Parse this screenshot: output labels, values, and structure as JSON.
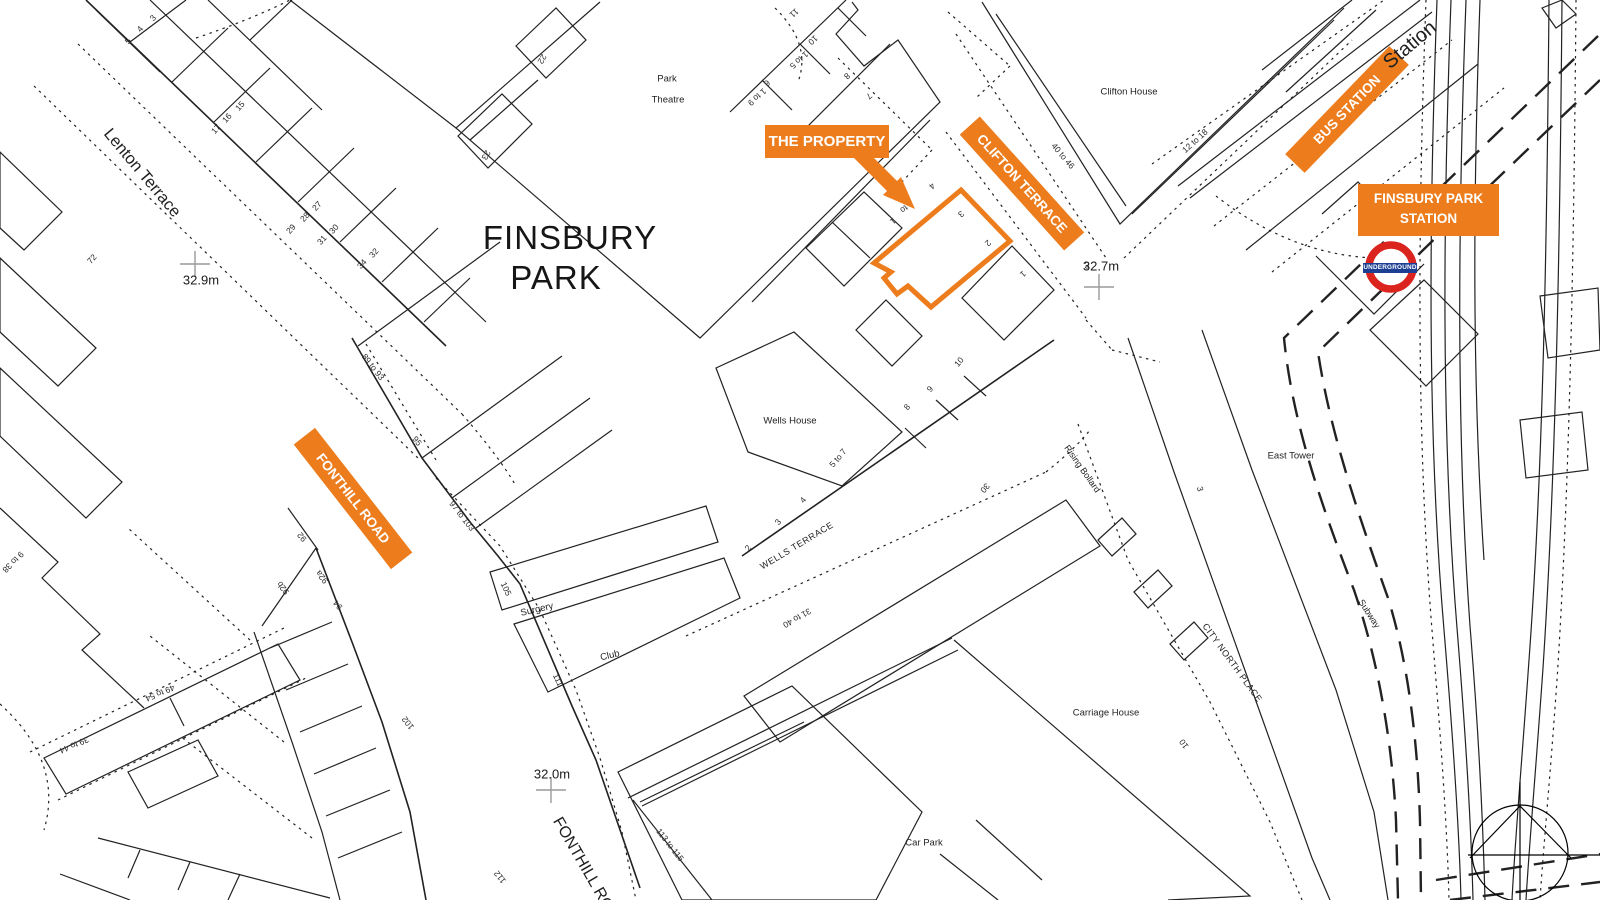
{
  "title": {
    "line1": "FINSBURY",
    "line2": "PARK"
  },
  "orange": {
    "accent": "#EC7C1C",
    "the_property": "THE PROPERTY",
    "clifton_terrace": "CLIFTON TERRACE",
    "bus_station": "BUS STATION",
    "station_line1": "FINSBURY PARK",
    "station_line2": "STATION",
    "fonthill_road": "FONTHILL ROAD"
  },
  "roundel": {
    "text": "UNDERGROUND",
    "red": "#DC241F",
    "blue": "#1C3F94"
  },
  "labels": [
    {
      "t": "Lenton Terrace",
      "x": 142,
      "y": 173,
      "r": 50,
      "s": 16.5,
      "c": "#1f1f1f",
      "n": "street-label-lenton-terrace"
    },
    {
      "t": "Station",
      "x": 1410,
      "y": 45,
      "r": -40,
      "s": 20,
      "c": "#1f1f1f",
      "n": "street-label-station"
    },
    {
      "t": "WELLS TERRACE",
      "x": 797,
      "y": 546,
      "r": -31,
      "s": 9,
      "ls": 0.6,
      "c": "#1f1f1f",
      "n": "street-label-wells-terrace"
    },
    {
      "t": "FONTHILL ROAD",
      "x": 588,
      "y": 874,
      "r": 60,
      "s": 16,
      "c": "#1f1f1f",
      "n": "street-label-fonthill-road-bottom"
    },
    {
      "t": "CITY NORTH PLACE",
      "x": 1232,
      "y": 663,
      "r": 54,
      "s": 9,
      "ls": 0.5,
      "c": "#1f1f1f",
      "n": "street-label-city-north-place"
    },
    {
      "t": "Subway",
      "x": 1369,
      "y": 614,
      "r": 57,
      "s": 9,
      "c": "#1f1f1f",
      "n": "street-label-subway"
    },
    {
      "t": "Rising Bollard",
      "x": 1082,
      "y": 469,
      "r": 55,
      "s": 9,
      "c": "#1f1f1f",
      "n": "annotation-rising-bollard"
    },
    {
      "t": "Park",
      "x": 667,
      "y": 79,
      "r": 0,
      "s": 9.5,
      "c": "#1f1f1f",
      "n": "building-label-park-theatre-1"
    },
    {
      "t": "Theatre",
      "x": 668,
      "y": 100,
      "r": 0,
      "s": 9.5,
      "c": "#1f1f1f",
      "n": "building-label-park-theatre-2"
    },
    {
      "t": "Clifton House",
      "x": 1129,
      "y": 92,
      "r": 0,
      "s": 9.5,
      "c": "#1f1f1f",
      "n": "building-label-clifton-house"
    },
    {
      "t": "Wells House",
      "x": 790,
      "y": 421,
      "r": 0,
      "s": 9.5,
      "c": "#1f1f1f",
      "n": "building-label-wells-house"
    },
    {
      "t": "Surgery",
      "x": 537,
      "y": 610,
      "r": -13,
      "s": 9.5,
      "c": "#1f1f1f",
      "n": "building-label-surgery"
    },
    {
      "t": "Club",
      "x": 610,
      "y": 656,
      "r": -13,
      "s": 9.5,
      "c": "#1f1f1f",
      "n": "building-label-club"
    },
    {
      "t": "East Tower",
      "x": 1291,
      "y": 456,
      "r": 0,
      "s": 9.5,
      "c": "#1f1f1f",
      "n": "building-label-east-tower"
    },
    {
      "t": "Carriage House",
      "x": 1106,
      "y": 713,
      "r": 0,
      "s": 9.5,
      "c": "#1f1f1f",
      "n": "building-label-carriage-house"
    },
    {
      "t": "Car Park",
      "x": 924,
      "y": 843,
      "r": 0,
      "s": 9.5,
      "c": "#1f1f1f",
      "n": "area-label-car-park"
    },
    {
      "t": "32.9m",
      "x": 201,
      "y": 280,
      "r": 0,
      "s": 13,
      "c": "#1a1a1a",
      "n": "spot-height-32-9m"
    },
    {
      "t": "32.7m",
      "x": 1101,
      "y": 266,
      "r": 0,
      "s": 13,
      "c": "#1a1a1a",
      "n": "spot-height-32-7m"
    },
    {
      "t": "32.0m",
      "x": 552,
      "y": 774,
      "r": 0,
      "s": 13,
      "c": "#1a1a1a",
      "n": "spot-height-32-0m"
    },
    {
      "t": "3",
      "x": 153,
      "y": 18,
      "r": -48,
      "n": "house-number"
    },
    {
      "t": "4",
      "x": 140,
      "y": 29,
      "r": -48,
      "n": "house-number"
    },
    {
      "t": "5",
      "x": 128,
      "y": 41,
      "r": -48,
      "n": "house-number"
    },
    {
      "t": "15",
      "x": 240,
      "y": 106,
      "r": -48,
      "n": "house-number"
    },
    {
      "t": "16",
      "x": 227,
      "y": 118,
      "r": -48,
      "n": "house-number"
    },
    {
      "t": "17",
      "x": 216,
      "y": 129,
      "r": -48,
      "n": "house-number"
    },
    {
      "t": "27",
      "x": 317,
      "y": 206,
      "r": -48,
      "n": "house-number"
    },
    {
      "t": "28",
      "x": 305,
      "y": 217,
      "r": -48,
      "n": "house-number"
    },
    {
      "t": "29",
      "x": 291,
      "y": 229,
      "r": -48,
      "n": "house-number"
    },
    {
      "t": "30",
      "x": 334,
      "y": 229,
      "r": -48,
      "n": "house-number"
    },
    {
      "t": "31",
      "x": 322,
      "y": 240,
      "r": -48,
      "n": "house-number"
    },
    {
      "t": "32",
      "x": 374,
      "y": 253,
      "r": -48,
      "n": "house-number"
    },
    {
      "t": "34",
      "x": 362,
      "y": 264,
      "r": -48,
      "n": "house-number"
    },
    {
      "t": "72",
      "x": 92,
      "y": 259,
      "r": -48,
      "n": "house-number"
    },
    {
      "t": "22",
      "x": 542,
      "y": 59,
      "r": 120,
      "n": "house-number"
    },
    {
      "t": "23",
      "x": 486,
      "y": 155,
      "r": 120,
      "n": "house-number"
    },
    {
      "t": "11",
      "x": 794,
      "y": 13,
      "r": 138,
      "n": "house-number"
    },
    {
      "t": "10",
      "x": 813,
      "y": 40,
      "r": 138,
      "n": "house-number"
    },
    {
      "t": "1 to 5",
      "x": 799,
      "y": 60,
      "r": 138,
      "n": "house-number"
    },
    {
      "t": "6",
      "x": 767,
      "y": 83,
      "r": 138,
      "n": "house-number"
    },
    {
      "t": "1 to 9",
      "x": 757,
      "y": 97,
      "r": 138,
      "n": "house-number"
    },
    {
      "t": "8",
      "x": 847,
      "y": 76,
      "r": 138,
      "n": "house-number"
    },
    {
      "t": "7",
      "x": 869,
      "y": 96,
      "r": 138,
      "n": "house-number"
    },
    {
      "t": "4",
      "x": 932,
      "y": 186,
      "r": 138,
      "n": "house-number"
    },
    {
      "t": "to",
      "x": 904,
      "y": 209,
      "r": 138,
      "n": "house-number"
    },
    {
      "t": "1",
      "x": 893,
      "y": 221,
      "r": 138,
      "n": "house-number"
    },
    {
      "t": "3",
      "x": 961,
      "y": 214,
      "r": 138,
      "n": "house-number"
    },
    {
      "t": "2",
      "x": 988,
      "y": 243,
      "r": 138,
      "n": "house-number"
    },
    {
      "t": "1",
      "x": 1023,
      "y": 274,
      "r": 138,
      "n": "house-number"
    },
    {
      "t": "40 to 46",
      "x": 1063,
      "y": 156,
      "r": 50,
      "n": "house-number"
    },
    {
      "t": "12 to 18",
      "x": 1195,
      "y": 141,
      "r": -42,
      "n": "house-number"
    },
    {
      "t": "3",
      "x": 1087,
      "y": 266,
      "r": 0,
      "s": 9,
      "n": "house-number"
    },
    {
      "t": "10",
      "x": 959,
      "y": 362,
      "r": -50,
      "n": "house-number"
    },
    {
      "t": "9",
      "x": 930,
      "y": 389,
      "r": -50,
      "n": "house-number"
    },
    {
      "t": "8",
      "x": 907,
      "y": 407,
      "r": -50,
      "n": "house-number"
    },
    {
      "t": "5 to 7",
      "x": 838,
      "y": 458,
      "r": -50,
      "n": "house-number"
    },
    {
      "t": "4",
      "x": 803,
      "y": 500,
      "r": -50,
      "n": "house-number"
    },
    {
      "t": "3",
      "x": 778,
      "y": 522,
      "r": -50,
      "n": "house-number"
    },
    {
      "t": "2",
      "x": 748,
      "y": 548,
      "r": -50,
      "n": "house-number"
    },
    {
      "t": "30",
      "x": 985,
      "y": 488,
      "r": 130,
      "n": "house-number"
    },
    {
      "t": "31 to 40",
      "x": 797,
      "y": 618,
      "r": 150,
      "n": "house-number"
    },
    {
      "t": "89 to 93",
      "x": 373,
      "y": 367,
      "r": 52,
      "n": "house-number"
    },
    {
      "t": "95",
      "x": 417,
      "y": 441,
      "r": 52,
      "n": "house-number"
    },
    {
      "t": "97 to 103",
      "x": 462,
      "y": 516,
      "r": 52,
      "n": "house-number"
    },
    {
      "t": "105",
      "x": 506,
      "y": 589,
      "r": 65,
      "n": "house-number"
    },
    {
      "t": "111",
      "x": 558,
      "y": 680,
      "r": 65,
      "n": "house-number"
    },
    {
      "t": "113 to 115",
      "x": 670,
      "y": 845,
      "r": 52,
      "n": "house-number"
    },
    {
      "t": "92",
      "x": 302,
      "y": 537,
      "r": 232,
      "n": "house-number"
    },
    {
      "t": "92a",
      "x": 322,
      "y": 577,
      "r": 232,
      "n": "house-number"
    },
    {
      "t": "92b",
      "x": 283,
      "y": 588,
      "r": 232,
      "n": "house-number"
    },
    {
      "t": "94",
      "x": 338,
      "y": 605,
      "r": 232,
      "n": "house-number"
    },
    {
      "t": "102",
      "x": 408,
      "y": 723,
      "r": 232,
      "n": "house-number"
    },
    {
      "t": "112",
      "x": 500,
      "y": 877,
      "r": 232,
      "n": "house-number"
    },
    {
      "t": "39 to 44",
      "x": 74,
      "y": 745,
      "r": 157,
      "n": "house-number"
    },
    {
      "t": "49 to 54",
      "x": 160,
      "y": 693,
      "r": 157,
      "n": "house-number"
    },
    {
      "t": "9 to 38",
      "x": 13,
      "y": 562,
      "r": 135,
      "n": "house-number"
    },
    {
      "t": "3",
      "x": 1200,
      "y": 489,
      "r": 75,
      "n": "house-number"
    },
    {
      "t": "10",
      "x": 1184,
      "y": 744,
      "r": 235,
      "n": "house-number"
    }
  ]
}
